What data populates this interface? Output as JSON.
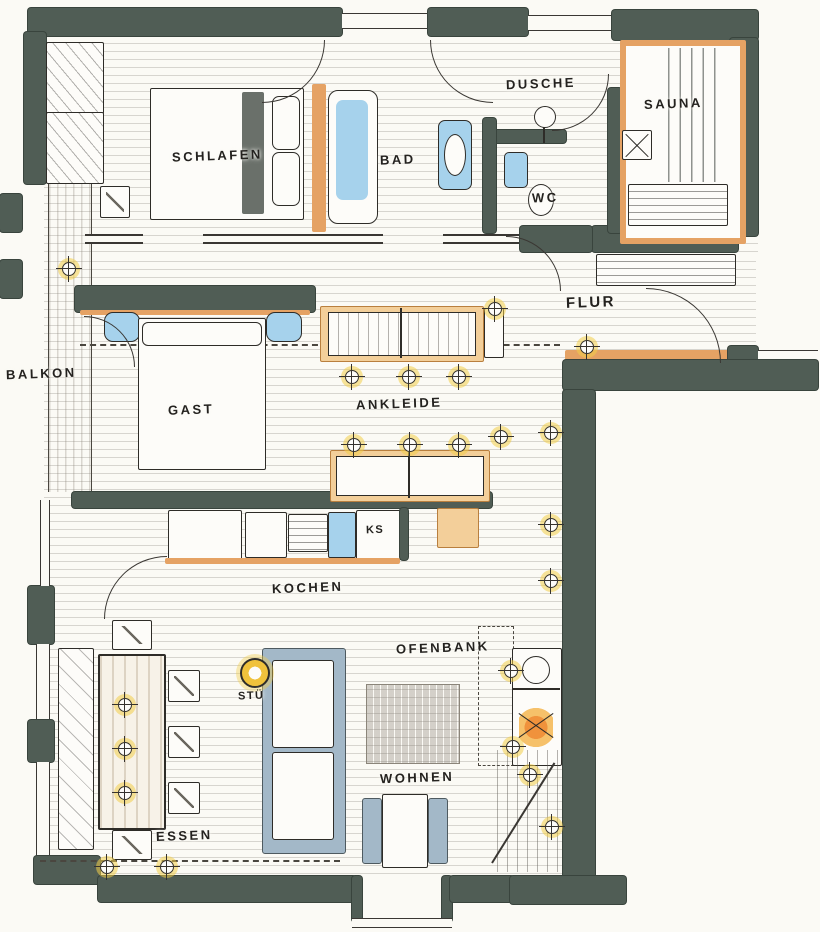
{
  "labels": {
    "schlafen": "SCHLAFEN",
    "bad": "BAD",
    "dusche": "DUSCHE",
    "sauna": "SAUNA",
    "wc": "WC",
    "flur": "FLUR",
    "balkon": "BALKON",
    "gast": "GAST",
    "ankleide": "ANKLEIDE",
    "ks": "KS",
    "kochen": "KOCHEN",
    "ofenbank": "OFENBANK",
    "stuetze": "STÜ",
    "wohnen": "WOHNEN",
    "essen": "ESSEN"
  },
  "palette": {
    "wall": "#505d55",
    "wood_accent": "#e5a264",
    "wood_light": "#f3cf9a",
    "water_blue": "#a6d2ec",
    "upholstery_blue": "#a3b8c8",
    "light_yellow": "#f2cd49",
    "flame_orange": "#f0923c",
    "paper": "#fbfaf5",
    "ink": "#2e2c28"
  }
}
